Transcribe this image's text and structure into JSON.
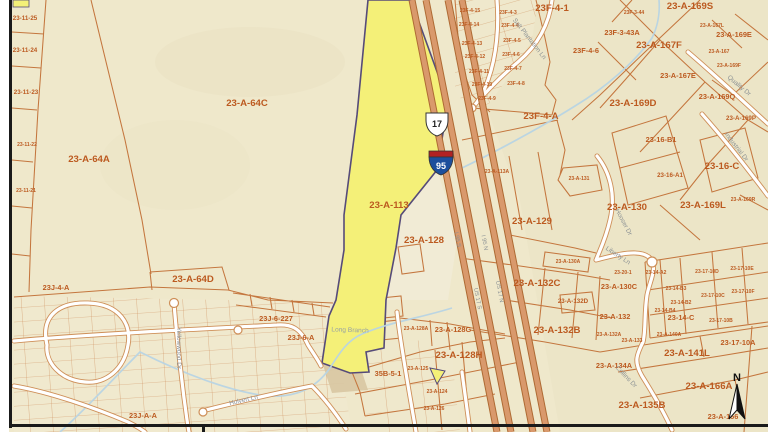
{
  "map": {
    "highlight_parcel": "23-A-113",
    "colors": {
      "base": "#EFE8CB",
      "highlight": "#F4F078",
      "highlight_outline": "#564B79",
      "parcel_line": "#C4763E",
      "parcel_label": "#BC5A20",
      "street_label": "#8B9194",
      "highway_stripe": "#D9996C",
      "stream": "#B7D4E4",
      "border": "#1A1A1A"
    },
    "shields": {
      "us_route": "17",
      "interstate": "95"
    },
    "compass_label": "N",
    "parcel_labels": [
      {
        "t": "23-11-25",
        "x": 25,
        "y": 20,
        "s": "S"
      },
      {
        "t": "23-11-24",
        "x": 25,
        "y": 52,
        "s": "S"
      },
      {
        "t": "23-11-23",
        "x": 26,
        "y": 94,
        "s": "S"
      },
      {
        "t": "23-11-22",
        "x": 27,
        "y": 146,
        "s": "T"
      },
      {
        "t": "23-11-21",
        "x": 26,
        "y": 192,
        "s": "T"
      },
      {
        "t": "23-A-64A",
        "x": 89,
        "y": 162,
        "s": "L"
      },
      {
        "t": "23-A-64C",
        "x": 247,
        "y": 106,
        "s": "L"
      },
      {
        "t": "23-A-64D",
        "x": 193,
        "y": 282,
        "s": "L"
      },
      {
        "t": "23-A-113",
        "x": 389,
        "y": 208,
        "s": "L"
      },
      {
        "t": "23-A-128",
        "x": 424,
        "y": 243,
        "s": "L"
      },
      {
        "t": "23J-4-A",
        "x": 56,
        "y": 290,
        "s": "M"
      },
      {
        "t": "23J-6-227",
        "x": 276,
        "y": 321,
        "s": "M"
      },
      {
        "t": "23J-6-A",
        "x": 301,
        "y": 340,
        "s": "M"
      },
      {
        "t": "23J-A-A",
        "x": 143,
        "y": 418,
        "s": "M"
      },
      {
        "t": "35B-5-1",
        "x": 388,
        "y": 376,
        "s": "M"
      },
      {
        "t": "23-A-128A",
        "x": 416,
        "y": 330,
        "s": "T"
      },
      {
        "t": "23-A-128G",
        "x": 453,
        "y": 332,
        "s": "M"
      },
      {
        "t": "23-A-128H",
        "x": 459,
        "y": 358,
        "s": "L"
      },
      {
        "t": "23-A-125",
        "x": 418,
        "y": 370,
        "s": "T"
      },
      {
        "t": "23-A-124",
        "x": 437,
        "y": 393,
        "s": "T"
      },
      {
        "t": "23-A-126",
        "x": 434,
        "y": 410,
        "s": "T"
      },
      {
        "t": "23F-4-1",
        "x": 552,
        "y": 11,
        "s": "L"
      },
      {
        "t": "23F-4-A",
        "x": 541,
        "y": 119,
        "s": "L"
      },
      {
        "t": "23F-4-15",
        "x": 470,
        "y": 12,
        "s": "T"
      },
      {
        "t": "23F-4-14",
        "x": 469,
        "y": 26,
        "s": "T"
      },
      {
        "t": "23F-4-13",
        "x": 472,
        "y": 45,
        "s": "T"
      },
      {
        "t": "23F-4-12",
        "x": 475,
        "y": 58,
        "s": "T"
      },
      {
        "t": "23F-4-11",
        "x": 479,
        "y": 73,
        "s": "T"
      },
      {
        "t": "23F-4-10",
        "x": 482,
        "y": 86,
        "s": "T"
      },
      {
        "t": "23F-4-9",
        "x": 487,
        "y": 100,
        "s": "T"
      },
      {
        "t": "23F-4-3",
        "x": 508,
        "y": 14,
        "s": "T"
      },
      {
        "t": "23F-4-4",
        "x": 510,
        "y": 27,
        "s": "T"
      },
      {
        "t": "23F-4-5",
        "x": 512,
        "y": 42,
        "s": "T"
      },
      {
        "t": "23F-4-6",
        "x": 511,
        "y": 56,
        "s": "T"
      },
      {
        "t": "23F-4-7",
        "x": 513,
        "y": 70,
        "s": "T"
      },
      {
        "t": "23F-4-8",
        "x": 516,
        "y": 85,
        "s": "T"
      },
      {
        "t": "23F-4-6",
        "x": 586,
        "y": 53,
        "s": "M"
      },
      {
        "t": "23F-3-44",
        "x": 634,
        "y": 14,
        "s": "T"
      },
      {
        "t": "23F-3-43A",
        "x": 622,
        "y": 35,
        "s": "M"
      },
      {
        "t": "23-A-169S",
        "x": 690,
        "y": 9,
        "s": "L"
      },
      {
        "t": "23-A-167F",
        "x": 659,
        "y": 48,
        "s": "L"
      },
      {
        "t": "23-A-167L",
        "x": 712,
        "y": 27,
        "s": "T"
      },
      {
        "t": "23-A-167",
        "x": 719,
        "y": 53,
        "s": "T"
      },
      {
        "t": "23-A-169F",
        "x": 729,
        "y": 67,
        "s": "T"
      },
      {
        "t": "23-A-167E",
        "x": 678,
        "y": 78,
        "s": "M"
      },
      {
        "t": "23-A-169E",
        "x": 734,
        "y": 37,
        "s": "M"
      },
      {
        "t": "23-A-169D",
        "x": 633,
        "y": 106,
        "s": "L"
      },
      {
        "t": "23-A-169Q",
        "x": 717,
        "y": 99,
        "s": "M"
      },
      {
        "t": "23-A-169P",
        "x": 741,
        "y": 120,
        "s": "S"
      },
      {
        "t": "23-16-B1",
        "x": 661,
        "y": 142,
        "s": "M"
      },
      {
        "t": "23-16-A1",
        "x": 670,
        "y": 177,
        "s": "S"
      },
      {
        "t": "23-16-C",
        "x": 722,
        "y": 169,
        "s": "L"
      },
      {
        "t": "23-A-131",
        "x": 579,
        "y": 180,
        "s": "T"
      },
      {
        "t": "23-A-113A",
        "x": 497,
        "y": 173,
        "s": "T"
      },
      {
        "t": "23-A-129",
        "x": 532,
        "y": 224,
        "s": "L"
      },
      {
        "t": "23-A-130",
        "x": 627,
        "y": 210,
        "s": "L"
      },
      {
        "t": "23-A-169L",
        "x": 703,
        "y": 208,
        "s": "L"
      },
      {
        "t": "23-A-169R",
        "x": 743,
        "y": 201,
        "s": "T"
      },
      {
        "t": "23-A-130A",
        "x": 568,
        "y": 263,
        "s": "T"
      },
      {
        "t": "23-A-132C",
        "x": 537,
        "y": 286,
        "s": "L"
      },
      {
        "t": "23-A-132D",
        "x": 573,
        "y": 303,
        "s": "S"
      },
      {
        "t": "23-A-132B",
        "x": 557,
        "y": 333,
        "s": "L"
      },
      {
        "t": "23-A-130C",
        "x": 619,
        "y": 289,
        "s": "M"
      },
      {
        "t": "23-20-1",
        "x": 623,
        "y": 274,
        "s": "T"
      },
      {
        "t": "23-14-A2",
        "x": 656,
        "y": 274,
        "s": "T"
      },
      {
        "t": "23-17-10D",
        "x": 707,
        "y": 273,
        "s": "T"
      },
      {
        "t": "23-17-10E",
        "x": 742,
        "y": 270,
        "s": "T"
      },
      {
        "t": "23-17-10F",
        "x": 743,
        "y": 293,
        "s": "T"
      },
      {
        "t": "23-17-10C",
        "x": 713,
        "y": 297,
        "s": "T"
      },
      {
        "t": "23-14-B3",
        "x": 676,
        "y": 290,
        "s": "T"
      },
      {
        "t": "23-14-B2",
        "x": 681,
        "y": 304,
        "s": "T"
      },
      {
        "t": "23-14-B4",
        "x": 665,
        "y": 312,
        "s": "T"
      },
      {
        "t": "23-A-132",
        "x": 615,
        "y": 319,
        "s": "M"
      },
      {
        "t": "23-14-C",
        "x": 681,
        "y": 320,
        "s": "M"
      },
      {
        "t": "23-17-10B",
        "x": 721,
        "y": 322,
        "s": "T"
      },
      {
        "t": "23-A-132A",
        "x": 609,
        "y": 336,
        "s": "T"
      },
      {
        "t": "23-A-133",
        "x": 632,
        "y": 342,
        "s": "T"
      },
      {
        "t": "23-A-140A",
        "x": 669,
        "y": 336,
        "s": "T"
      },
      {
        "t": "23-17-10A",
        "x": 738,
        "y": 345,
        "s": "M"
      },
      {
        "t": "23-A-141L",
        "x": 687,
        "y": 356,
        "s": "L"
      },
      {
        "t": "23-A-134A",
        "x": 614,
        "y": 368,
        "s": "M"
      },
      {
        "t": "23-A-166A",
        "x": 709,
        "y": 389,
        "s": "L"
      },
      {
        "t": "23-A-135B",
        "x": 642,
        "y": 408,
        "s": "L"
      },
      {
        "t": "23-A-166",
        "x": 723,
        "y": 419,
        "s": "M"
      }
    ],
    "street_labels": [
      {
        "t": "Salt Plantation Ln",
        "x": 528,
        "y": 40,
        "r": 52
      },
      {
        "t": "Quality Dr",
        "x": 738,
        "y": 87,
        "r": 40
      },
      {
        "t": "Industrial Dr",
        "x": 735,
        "y": 148,
        "r": 52
      },
      {
        "t": "Hooser Dr",
        "x": 622,
        "y": 223,
        "r": 62
      },
      {
        "t": "Liberty Ln",
        "x": 617,
        "y": 257,
        "r": 33
      },
      {
        "t": "Collins Dr",
        "x": 625,
        "y": 378,
        "r": 46
      },
      {
        "t": "Yellowwood Dr",
        "x": 177,
        "y": 348,
        "r": 90
      },
      {
        "t": "Hulvert Ln",
        "x": 244,
        "y": 402,
        "r": -13
      }
    ],
    "highway_labels": [
      {
        "t": "I 95 S",
        "x": 456,
        "y": 240,
        "r": 79
      },
      {
        "t": "I 95 N",
        "x": 483,
        "y": 243,
        "r": 79
      },
      {
        "t": "US 17 S",
        "x": 476,
        "y": 299,
        "r": 79
      },
      {
        "t": "US 17 N",
        "x": 498,
        "y": 292,
        "r": 79
      }
    ],
    "water_labels": [
      {
        "t": "Long Branch",
        "x": 350,
        "y": 332,
        "r": 2
      }
    ]
  }
}
